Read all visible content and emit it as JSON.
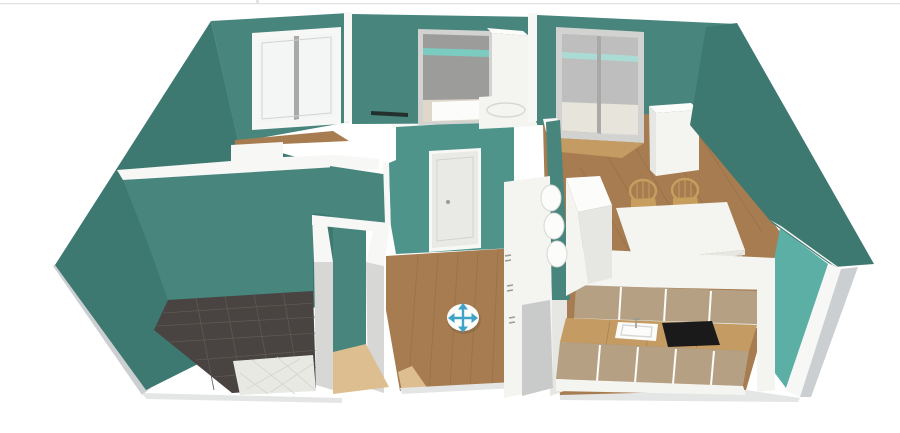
{
  "canvas": {
    "width": 900,
    "height": 433
  },
  "colors": {
    "bg": "#ffffff",
    "topBorder": "#e2e2e2",
    "wallDark": "#3E7971",
    "wall": "#47857D",
    "wallLit": "#4F948B",
    "wallBright": "#5BAFA4",
    "trimTeal": "#7CCBC0",
    "wallTop": "#F7F7F5",
    "cutGray": "#D7D7D5",
    "grayPanel": "#C9CBCB",
    "plinth": "#CCCFD1",
    "plinthLight": "#E4E6E6",
    "balconyWall": "#9C9C9A",
    "balconyFloor": "#DFD8CA",
    "wood": "#A67C50",
    "woodDark": "#8A6642",
    "woodLight": "#C49B62",
    "threshold": "#DCBE90",
    "tileDark": "#494341",
    "tileGrout": "#5F5955",
    "tileWhite": "#E9E9E4",
    "tileWhiteGrout": "#D4D4CE",
    "white": "#F4F4F1",
    "whiteShade": "#E6E6E2",
    "whiteBright": "#FCFCFA",
    "tan": "#B5A083",
    "black": "#1A1A1A",
    "frame": "#D2D2D0",
    "frameGray": "#A9A9A7",
    "glass": "#F4F6F6",
    "doorWhite": "#E9E9E6",
    "knob": "#9B9B99",
    "wicker": "#C79E5E",
    "moveBlue": "#3FA3C8",
    "shadowTint": "rgba(0,0,0,0.10)"
  },
  "scene": {
    "type": "3d-floorplan-render",
    "view": "elevated front-left perspective, walls cut open at top",
    "wall_theme": "teal walls with white wall tops and gray base plinths",
    "rooms": [
      {
        "name": "bedroom",
        "position": "top-left",
        "floor": "wood",
        "features": [
          "double casement window"
        ]
      },
      {
        "name": "bathroom",
        "position": "bottom-left",
        "floor": "dark gray tile with white tile section",
        "features": [
          "open doorway with wood threshold"
        ]
      },
      {
        "name": "hallway",
        "position": "center",
        "floor": "wood",
        "features": [
          "white entry door with knob",
          "tall white wardrobe"
        ]
      },
      {
        "name": "utility-room",
        "position": "top-center",
        "floor": "light",
        "features": [
          "open doorway to gray balcony",
          "white cabinet",
          "white washbasin",
          "dark wall strip"
        ]
      },
      {
        "name": "living-dining",
        "position": "top-right",
        "floor": "wood",
        "features": [
          "sliding glass balcony door",
          "tall white cabinet",
          "white dining table",
          "two wicker chairs",
          "white peninsula with rounded shelf ends"
        ]
      },
      {
        "name": "kitchen",
        "position": "bottom-right",
        "floor": "wood",
        "features": [
          "tan upper cabinet doors",
          "wood countertop",
          "white sink with faucet",
          "black cooktop",
          "tan lower cabinet doors"
        ]
      },
      {
        "name": "balcony",
        "position": "behind top-center and top-right doors",
        "features": [
          "gray walls",
          "teal trim band",
          "light floor"
        ]
      }
    ],
    "controls": [
      {
        "name": "move-handle",
        "icon": "four-way-arrows-in-circle",
        "color": "#3FA3C8"
      }
    ]
  }
}
